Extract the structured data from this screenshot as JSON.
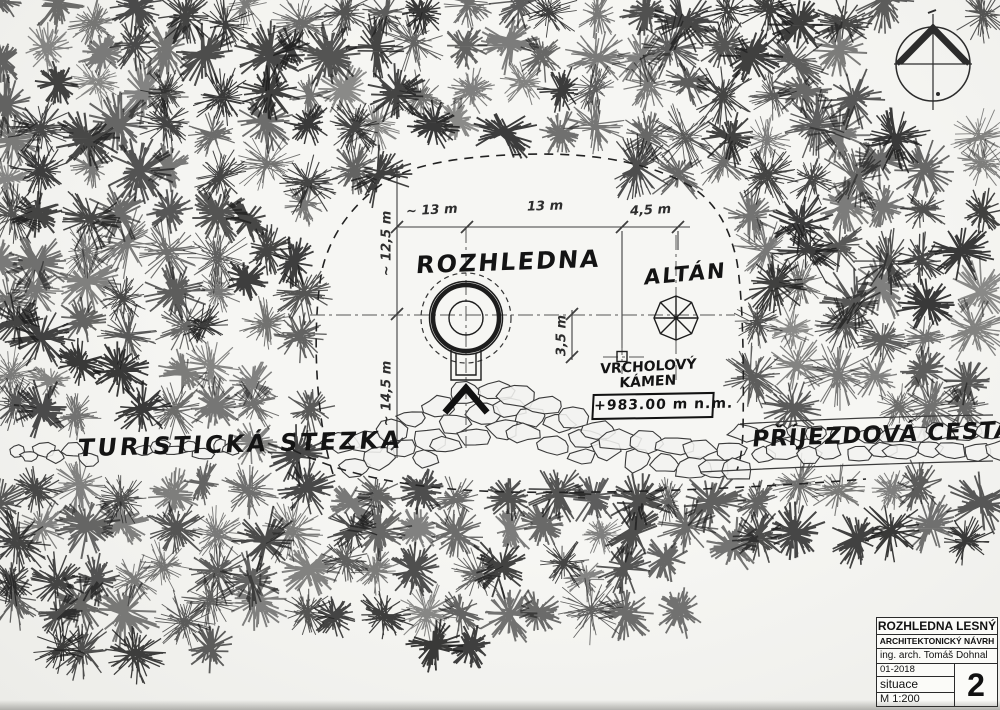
{
  "colors": {
    "paper": "#f3f3f0",
    "ink": "#1d1d1d",
    "thin_line": "#3f3f3f",
    "centerline": "#555555"
  },
  "labels": {
    "tower": "ROZHLEDNA",
    "gazebo": "ALTÁN",
    "summit_stone": "VRCHOLOVÝ KÁMEN",
    "elevation": "+983.00 m n.m.",
    "trail": "TURISTICKÁ STEZKA",
    "road": "PŘÍJEZDOVÁ CESTA"
  },
  "dimensions": {
    "top_left": "~ 13 m",
    "top_mid": "13 m",
    "top_right": "4,5 m",
    "left_upper": "~ 12,5 m",
    "left_lower": "~ 14,5 m",
    "stone_offset": "3,5 m"
  },
  "title_block": {
    "project": "ROZHLEDNA LESNÝ",
    "subtitle": "ARCHITEKTONICKÝ NÁVRH",
    "author": "ing. arch. Tomáš Dohnal",
    "date": "01-2018",
    "drawing": "situace",
    "scale": "M 1:200",
    "sheet": "2"
  }
}
